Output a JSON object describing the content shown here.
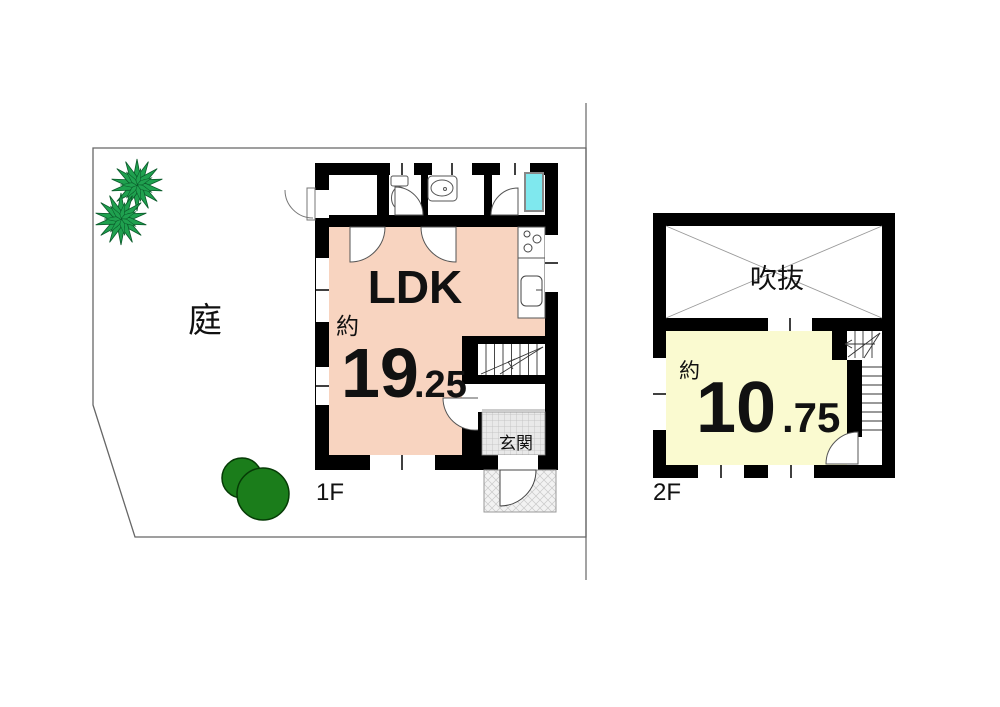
{
  "plan": {
    "type": "japanese-floor-plan",
    "labels": {
      "garden": "庭",
      "floor1": "1F",
      "floor2": "2F",
      "ldk": "LDK",
      "approx1": "約",
      "area1_int": "19",
      "area1_dec": ".25",
      "genkan": "玄関",
      "void": "吹抜",
      "approx2": "約",
      "area2_int": "10",
      "area2_dec": ".75"
    },
    "rooms": [
      {
        "floor": "1F",
        "name": "LDK",
        "size_mats": "約19.25",
        "fill": "#f8d4c0"
      },
      {
        "floor": "1F",
        "name": "玄関"
      },
      {
        "floor": "2F",
        "name": "洋室",
        "size_mats": "約10.75",
        "fill": "#fafad0"
      },
      {
        "floor": "2F",
        "name": "吹抜"
      }
    ],
    "colors": {
      "ldk_fill": "#f8d4c0",
      "room2f_fill": "#fafad0",
      "bathtub_fill": "#7fe8ee",
      "palm_green": "#1fa14f",
      "bush_green": "#1b7d1b",
      "wall": "#000000",
      "boundary": "#666666",
      "mat_gray": "#e9e9e9",
      "porch_gray": "#f2f2f2"
    }
  }
}
